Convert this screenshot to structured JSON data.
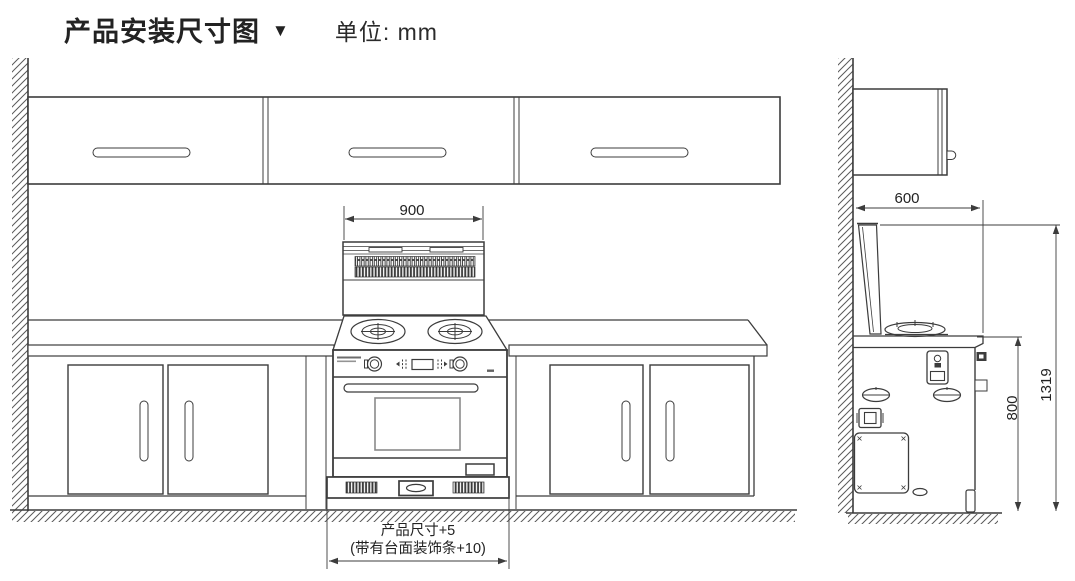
{
  "title": {
    "text": "产品安装尺寸图",
    "marker": "▼",
    "unit": "单位: mm"
  },
  "dimensions": {
    "hood_width": "900",
    "cabinet_depth": "600",
    "counter_height": "800",
    "total_height": "1319",
    "note_line1": "产品尺寸+5",
    "note_line2": "(带有台面装饰条+10)"
  },
  "colors": {
    "line": "#3c3c3c",
    "ink": "#222222",
    "bg": "#ffffff"
  }
}
